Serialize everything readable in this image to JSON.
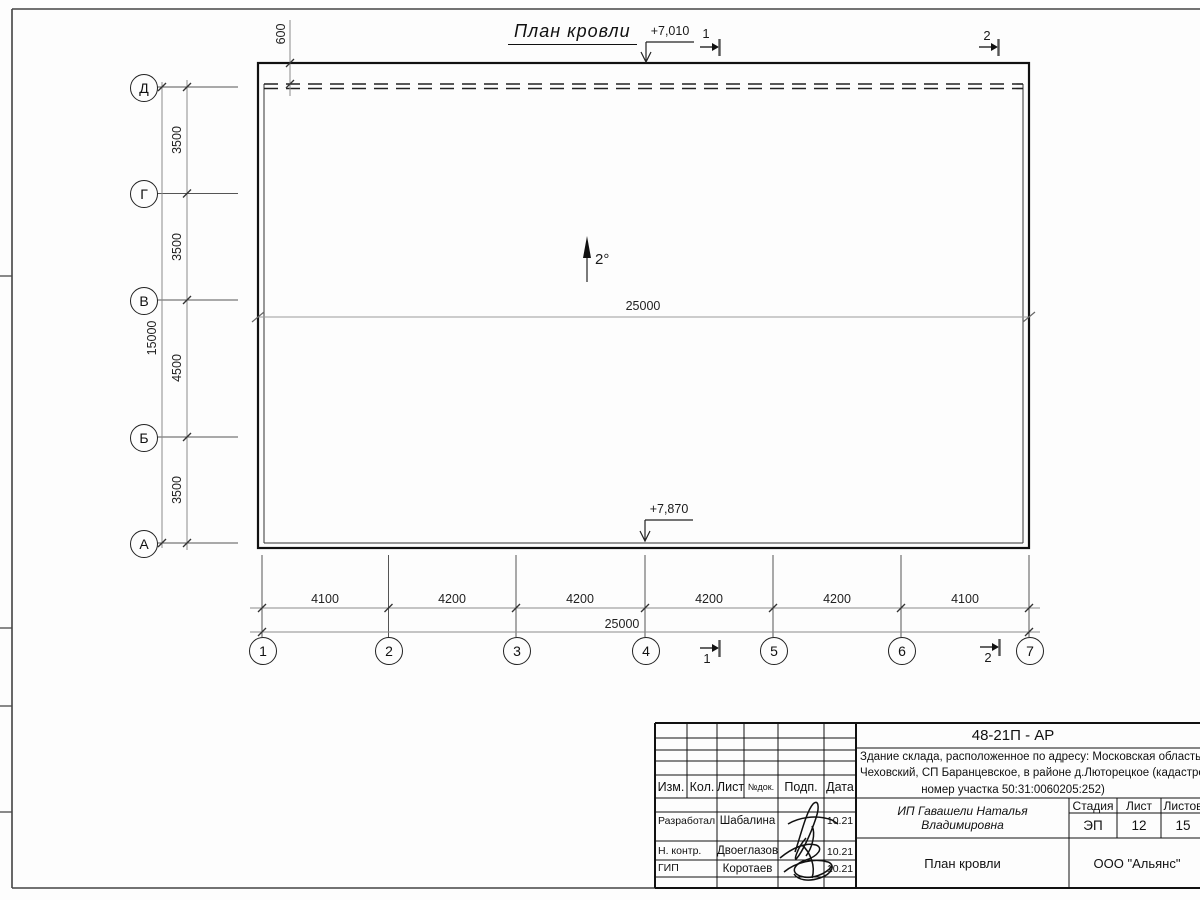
{
  "sheet": {
    "title": "План кровли",
    "slope_label": "2°",
    "ridge_dimension": "25000",
    "elevation_top": "+7,010",
    "elevation_bottom": "+7,870",
    "overhang_dimension": "600",
    "section_mark_1": "1",
    "section_mark_2": "2"
  },
  "axes": {
    "rows": [
      "Д",
      "Г",
      "В",
      "Б",
      "А"
    ],
    "cols": [
      "1",
      "2",
      "3",
      "4",
      "5",
      "6",
      "7"
    ],
    "row_dims": [
      "3500",
      "3500",
      "4500",
      "3500"
    ],
    "row_total": "15000",
    "col_dims": [
      "4100",
      "4200",
      "4200",
      "4200",
      "4200",
      "4100"
    ],
    "col_total": "25000"
  },
  "title_block": {
    "code": "48-21П - АР",
    "description_line1": "Здание склада, расположенное по адресу: Московская область, р",
    "description_line2": "Чеховский, СП Баранцевское, в районе д.Люторецкое  (кадастровы",
    "description_line3": "номер участка 50:31:0060205:252)",
    "columns": {
      "izm": "Изм.",
      "kol": "Кол.",
      "list": "Лист",
      "ndok": "№док.",
      "podp": "Подп.",
      "data": "Дата"
    },
    "rows": [
      {
        "role": "Разработал",
        "name": "Шабалина",
        "date": "10.21"
      },
      {
        "role": "Н. контр.",
        "name": "Двоеглазов",
        "date": "10.21"
      },
      {
        "role": "ГИП",
        "name": "Коротаев",
        "date": "10.21"
      }
    ],
    "client": "ИП Гавашели Наталья Владимировна",
    "stage_label": "Стадия",
    "sheet_label": "Лист",
    "sheets_label": "Листов",
    "stage": "ЭП",
    "sheet_no": "12",
    "sheets_total": "15",
    "drawing_name": "План кровли",
    "company": "ООО \"Альянс\""
  }
}
